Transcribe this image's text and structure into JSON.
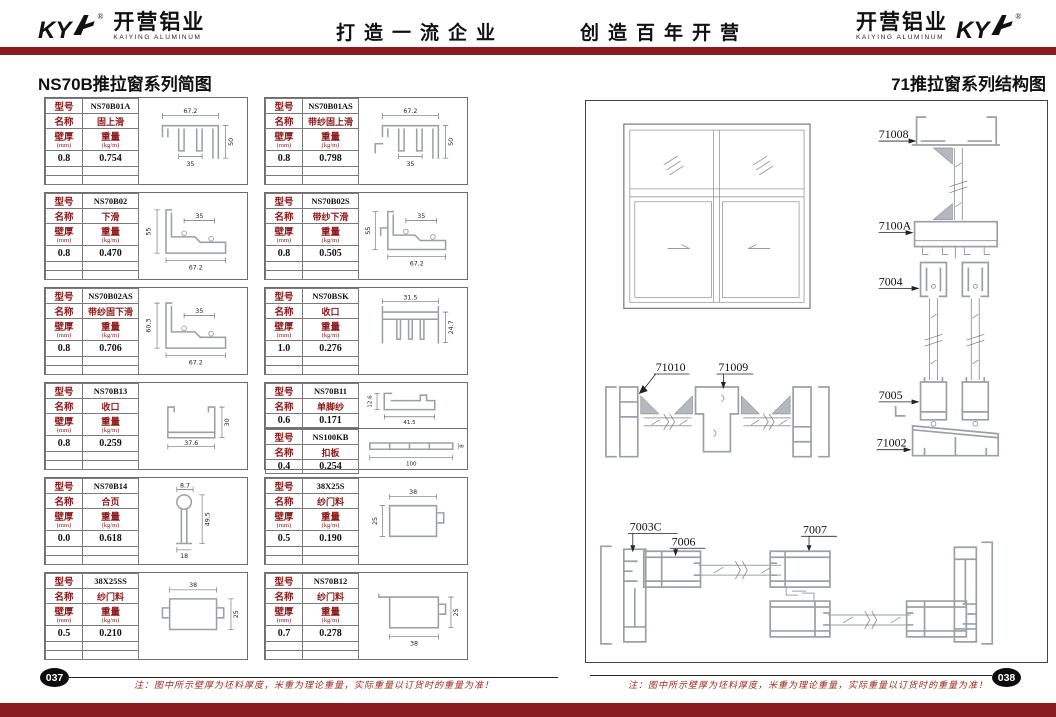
{
  "header": {
    "logo_left": {
      "ky": "KY",
      "reg": "®",
      "cn": "开营铝业",
      "en": "KAIYING ALUMINUM"
    },
    "slogan_left": "打造一流企业",
    "slogan_right": "创造百年开营",
    "logo_right": {
      "cn": "开营铝业",
      "en": "KAIYING ALUMINUM",
      "ky": "KY",
      "reg": "®"
    }
  },
  "left_section": {
    "title": "NS70B推拉窗系列简图",
    "labels": {
      "model": "型号",
      "name": "名称",
      "thickness": "壁厚",
      "thickness_unit": "(mm)",
      "weight": "重量",
      "weight_unit": "(kg/m)"
    },
    "cards": [
      {
        "model": "NS70B01A",
        "name": "固上滑",
        "thickness": "0.8",
        "weight": "0.754",
        "d1": "67.2",
        "d2": "35",
        "d3": "50"
      },
      {
        "model": "NS70B01AS",
        "name": "带纱固上滑",
        "thickness": "0.8",
        "weight": "0.798",
        "d1": "67.2",
        "d2": "35",
        "d3": "50"
      },
      {
        "model": "NS70B02",
        "name": "下滑",
        "thickness": "0.8",
        "weight": "0.470",
        "d1": "55",
        "d2": "35",
        "d3": "67.2"
      },
      {
        "model": "NS70B02S",
        "name": "带纱下滑",
        "thickness": "0.8",
        "weight": "0.505",
        "d1": "55",
        "d2": "35",
        "d3": "67.2"
      },
      {
        "model": "NS70B02AS",
        "name": "带纱固下滑",
        "thickness": "0.8",
        "weight": "0.706",
        "d1": "60.3",
        "d2": "35",
        "d3": "67.2"
      },
      {
        "model": "NS70BSK",
        "name": "收口",
        "thickness": "1.0",
        "weight": "0.276",
        "d1": "31.5",
        "d2": "24.7"
      },
      {
        "model": "NS70B13",
        "name": "收口",
        "thickness": "0.8",
        "weight": "0.259",
        "d1": "37.6",
        "d2": "30"
      },
      {
        "model": "NS70B11",
        "name": "单脚纱",
        "thickness": "0.6",
        "weight": "0.171",
        "d1": "12.6",
        "d2": "41.5"
      },
      {
        "model": "NS100KB",
        "name": "扣板",
        "thickness": "0.4",
        "weight": "0.254",
        "d1": "100",
        "d2": "8"
      },
      {
        "model": "NS70B14",
        "name": "合页",
        "thickness": "0.0",
        "weight": "0.618",
        "d1": "8.7",
        "d2": "49.5",
        "d3": "18"
      },
      {
        "model": "38X25S",
        "name": "纱门料",
        "thickness": "0.5",
        "weight": "0.190",
        "d1": "38",
        "d2": "25"
      },
      {
        "model": "38X25SS",
        "name": "纱门料",
        "thickness": "0.5",
        "weight": "0.210",
        "d1": "38",
        "d2": "25"
      },
      {
        "model": "NS70B12",
        "name": "纱门料",
        "thickness": "0.7",
        "weight": "0.278",
        "d1": "38",
        "d2": "25"
      }
    ]
  },
  "right_section": {
    "title": "71推拉窗系列结构图",
    "labels": {
      "p71008": "71008",
      "p7100A": "7100A",
      "p7004": "7004",
      "p7005": "7005",
      "p71002": "71002",
      "p71010": "71010",
      "p71009": "71009",
      "p7003C": "7003C",
      "p7006": "7006",
      "p7007": "7007"
    }
  },
  "footer": {
    "page_left": "037",
    "page_right": "038",
    "note_left": "注：图中所示壁厚为坯料厚度，米重为理论重量，实际重量以订货时的重量为准！",
    "note_right": "注：图中所示壁厚为坯料厚度，米重为理论重量，实际重量以订货时的重量为准！"
  },
  "colors": {
    "accent_red": "#8a1c1f",
    "table_label_red": "#8b1a1a",
    "badge_black": "#0d0d0d"
  }
}
